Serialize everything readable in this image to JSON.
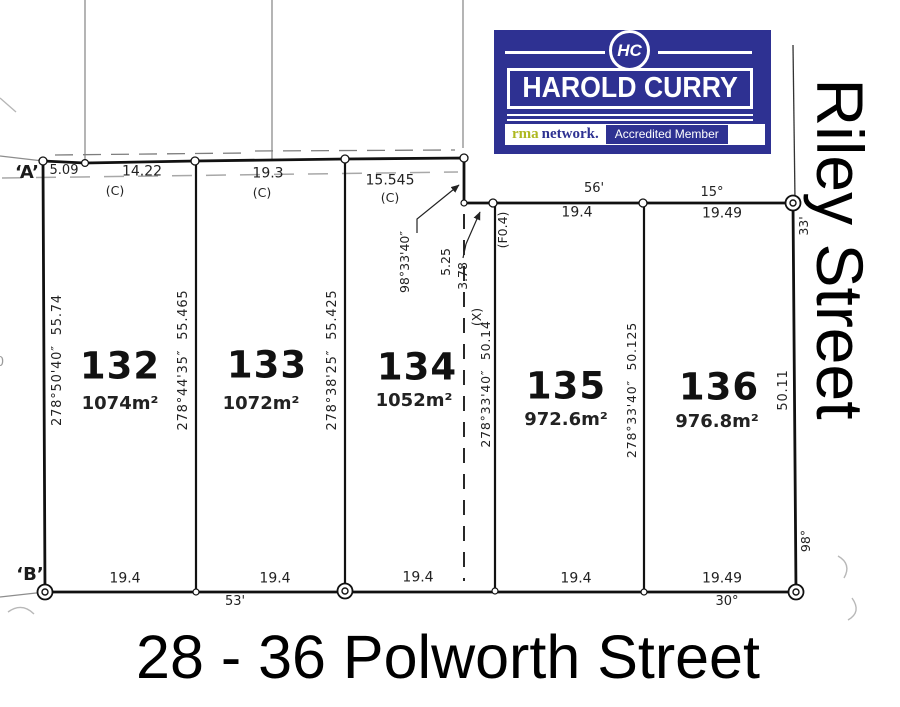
{
  "plan": {
    "corners": {
      "a": "‘A’",
      "b": "‘B’"
    },
    "fragment": "0",
    "top": {
      "m1": "5.09",
      "m2": "14.22",
      "m3": "19.3",
      "m4": "15.545",
      "c": "(C)",
      "lot135_old": "56'",
      "lot135": "19.4",
      "lot136_old": "15°",
      "lot136": "19.49"
    },
    "right": {
      "old_top": "33'",
      "frontage": "50.11",
      "old_bottom": "98°"
    },
    "bottom": {
      "lot132": "19.4",
      "old_132_133": "53'",
      "lot133": "19.4",
      "lot134": "19.4",
      "lot135": "19.4",
      "lot136": "19.49",
      "old_136": "30°"
    },
    "bearings": {
      "lot132_west": "278°50'40″  55.74",
      "lot132_133": "278°44'35″  55.465",
      "lot133_134": "278°38'25″  55.425",
      "old_x": "278°33'40″  50.14",
      "old_x_tag": "(X)",
      "lot135_136": "278°33'40″  50.125",
      "jog_bearing": "98°33'40″",
      "jog_dist": "5.25",
      "jog_depth": "3.78",
      "fence_tag": "(F0.4)"
    },
    "lots": [
      {
        "number": "132",
        "area": "1074m²"
      },
      {
        "number": "133",
        "area": "1072m²"
      },
      {
        "number": "134",
        "area": "1052m²"
      },
      {
        "number": "135",
        "area": "972.6m²"
      },
      {
        "number": "136",
        "area": "976.8m²"
      }
    ]
  },
  "streets": {
    "bottom": "28 - 36 Polworth Street",
    "side": "Riley Street"
  },
  "logo": {
    "monogram": "HC",
    "name": "HAROLD CURRY",
    "rma": "rma",
    "network": "network.",
    "badge": "Accredited Member",
    "navy": "#2e3192",
    "green": "#aeb821"
  }
}
